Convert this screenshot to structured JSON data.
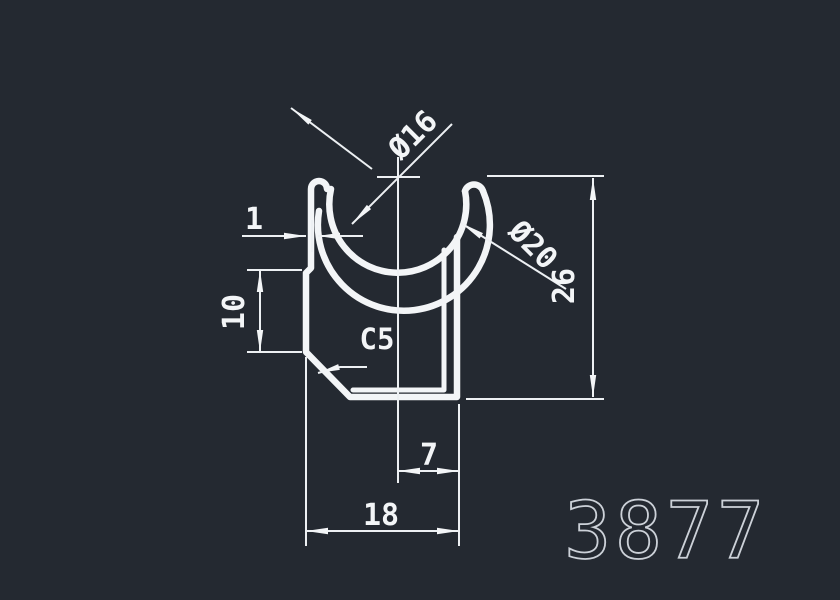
{
  "canvas": {
    "background_color": "#242931",
    "line_color": "#f3f5f7",
    "big_label_color": "#ccd1d8"
  },
  "drawing": {
    "profile_number": "3877",
    "dimensions": [
      {
        "id": "groove-inner-diameter",
        "label": "Ø16"
      },
      {
        "id": "groove-outer-diameter",
        "label": "Ø20"
      },
      {
        "id": "overall-height",
        "label": "26"
      },
      {
        "id": "lip-wall-thickness",
        "label": "1"
      },
      {
        "id": "left-wall-height",
        "label": "10"
      },
      {
        "id": "chamfer",
        "label": "C5"
      },
      {
        "id": "bottom-offset",
        "label": "7"
      },
      {
        "id": "overall-width",
        "label": "18"
      }
    ]
  }
}
